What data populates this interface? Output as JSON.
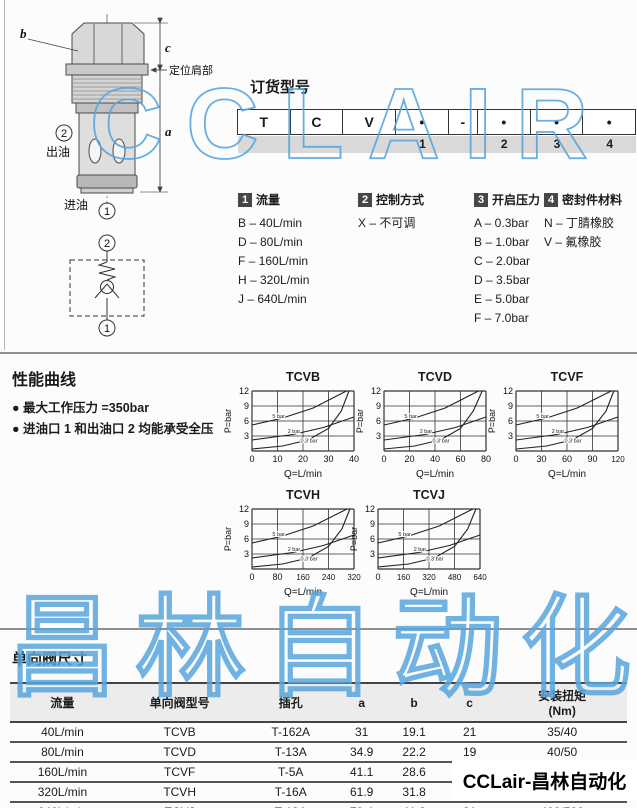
{
  "brand": {
    "label": "CCLair-昌林自动化"
  },
  "watermarks": {
    "top": "CCLAIR",
    "bottom": "昌林自动化",
    "color": "#58a6de"
  },
  "drawing": {
    "dim_b": "b",
    "dim_c": "c",
    "dim_a": "a",
    "shoulder_label": "定位肩部",
    "outlet_num": "2",
    "outlet_label": "出油",
    "inlet_label": "进油",
    "inlet_num": "1",
    "symbol_top_num": "2",
    "symbol_bottom_num": "1"
  },
  "ordering": {
    "title": "订货型号",
    "cells": [
      "T",
      "C",
      "V",
      "•",
      "-",
      "•",
      "•",
      "•"
    ],
    "cell_numbers": [
      "",
      "",
      "",
      "1",
      "",
      "2",
      "3",
      "4"
    ],
    "groups": [
      {
        "num": "1",
        "title": "流量",
        "options": [
          "B – 40L/min",
          "D – 80L/min",
          "F – 160L/min",
          "H – 320L/min",
          "J – 640L/min"
        ]
      },
      {
        "num": "2",
        "title": "控制方式",
        "options": [
          "X – 不可调"
        ]
      },
      {
        "num": "3",
        "title": "开启压力",
        "options": [
          "A – 0.3bar",
          "B – 1.0bar",
          "C – 2.0bar",
          "D – 3.5bar",
          "E – 5.0bar",
          "F – 7.0bar"
        ]
      },
      {
        "num": "4",
        "title": "密封件材料",
        "options": [
          "N – 丁腈橡胶",
          "V – 氟橡胶"
        ]
      }
    ]
  },
  "performance": {
    "title": "性能曲线",
    "bullets": [
      "最大工作压力 =350bar",
      "进油口 1 和出油口 2 均能承受全压"
    ]
  },
  "chart_data": [
    {
      "type": "line",
      "title": "TCVB",
      "xlabel": "Q=L/min",
      "ylabel": "P=bar",
      "xmax": 40,
      "ylim": [
        0,
        12
      ],
      "x_ticks": [
        0,
        10,
        20,
        30,
        40
      ],
      "y_ticks": [
        0,
        3,
        6,
        9,
        12
      ],
      "grid": true,
      "series": [
        {
          "name": "5 bar",
          "x": [
            0,
            12,
            24,
            37
          ],
          "y": [
            5.2,
            6.6,
            8.6,
            12
          ],
          "label_at": [
            8,
            6.6
          ]
        },
        {
          "name": "2 bar",
          "x": [
            0,
            16,
            28,
            40
          ],
          "y": [
            2.2,
            3.3,
            4.7,
            6.8
          ],
          "label_at": [
            14,
            3.6
          ]
        },
        {
          "name": "0.3 bar",
          "x": [
            0,
            12,
            22,
            30,
            35,
            38
          ],
          "y": [
            0.4,
            1,
            2.2,
            4.5,
            8,
            12
          ],
          "label_at": [
            19,
            1.7
          ]
        }
      ]
    },
    {
      "type": "line",
      "title": "TCVD",
      "xlabel": "Q=L/min",
      "ylabel": "P=bar",
      "xmax": 80,
      "ylim": [
        0,
        12
      ],
      "x_ticks": [
        0,
        20,
        40,
        60,
        80
      ],
      "y_ticks": [
        0,
        3,
        6,
        9,
        12
      ],
      "grid": true,
      "series": [
        {
          "name": "5 bar",
          "x": [
            0,
            24,
            48,
            74
          ],
          "y": [
            5.2,
            6.6,
            8.6,
            12
          ],
          "label_at": [
            16,
            6.6
          ]
        },
        {
          "name": "2 bar",
          "x": [
            0,
            32,
            56,
            80
          ],
          "y": [
            2.2,
            3.3,
            4.7,
            6.8
          ],
          "label_at": [
            28,
            3.6
          ]
        },
        {
          "name": "0.3 bar",
          "x": [
            0,
            24,
            44,
            60,
            70,
            77
          ],
          "y": [
            0.4,
            1,
            2.2,
            4.5,
            8,
            12
          ],
          "label_at": [
            38,
            1.7
          ]
        }
      ]
    },
    {
      "type": "line",
      "title": "TCVF",
      "xlabel": "Q=L/min",
      "ylabel": "P=bar",
      "xmax": 120,
      "ylim": [
        0,
        12
      ],
      "x_ticks": [
        0,
        30,
        60,
        90,
        120
      ],
      "y_ticks": [
        0,
        3,
        6,
        9,
        12
      ],
      "grid": true,
      "series": [
        {
          "name": "5 bar",
          "x": [
            0,
            36,
            72,
            112
          ],
          "y": [
            5.2,
            6.6,
            8.6,
            12
          ],
          "label_at": [
            24,
            6.6
          ]
        },
        {
          "name": "2 bar",
          "x": [
            0,
            48,
            84,
            120
          ],
          "y": [
            2.2,
            3.3,
            4.7,
            6.8
          ],
          "label_at": [
            42,
            3.6
          ]
        },
        {
          "name": "0.3 bar",
          "x": [
            0,
            36,
            66,
            90,
            106,
            115
          ],
          "y": [
            0.4,
            1,
            2.2,
            4.5,
            8,
            12
          ],
          "label_at": [
            57,
            1.7
          ]
        }
      ]
    },
    {
      "type": "line",
      "title": "TCVH",
      "xlabel": "Q=L/min",
      "ylabel": "P=bar",
      "xmax": 320,
      "ylim": [
        0,
        12
      ],
      "x_ticks": [
        0,
        80,
        160,
        240,
        320
      ],
      "y_ticks": [
        0,
        3,
        6,
        9,
        12
      ],
      "grid": true,
      "series": [
        {
          "name": "5 bar",
          "x": [
            0,
            96,
            192,
            298
          ],
          "y": [
            5.2,
            6.6,
            8.6,
            12
          ],
          "label_at": [
            64,
            6.6
          ]
        },
        {
          "name": "2 bar",
          "x": [
            0,
            128,
            224,
            320
          ],
          "y": [
            2.2,
            3.3,
            4.7,
            6.8
          ],
          "label_at": [
            112,
            3.6
          ]
        },
        {
          "name": "0.3 bar",
          "x": [
            0,
            96,
            176,
            240,
            282,
            307
          ],
          "y": [
            0.4,
            1,
            2.2,
            4.5,
            8,
            12
          ],
          "label_at": [
            152,
            1.7
          ]
        }
      ]
    },
    {
      "type": "line",
      "title": "TCVJ",
      "xlabel": "Q=L/min",
      "ylabel": "P=bar",
      "xmax": 640,
      "ylim": [
        0,
        12
      ],
      "x_ticks": [
        0,
        160,
        320,
        480,
        640
      ],
      "y_ticks": [
        0,
        3,
        6,
        9,
        12
      ],
      "grid": true,
      "series": [
        {
          "name": "5 bar",
          "x": [
            0,
            192,
            384,
            595
          ],
          "y": [
            5.2,
            6.6,
            8.6,
            12
          ],
          "label_at": [
            128,
            6.6
          ]
        },
        {
          "name": "2 bar",
          "x": [
            0,
            256,
            448,
            640
          ],
          "y": [
            2.2,
            3.3,
            4.7,
            6.8
          ],
          "label_at": [
            224,
            3.6
          ]
        },
        {
          "name": "0.3 bar",
          "x": [
            0,
            192,
            352,
            480,
            563,
            614
          ],
          "y": [
            0.4,
            1,
            2.2,
            4.5,
            8,
            12
          ],
          "label_at": [
            304,
            1.7
          ]
        }
      ]
    }
  ],
  "dimensions": {
    "title": "单向阀尺寸",
    "headers": [
      "流量",
      "单向阀型号",
      "插孔",
      "a",
      "b",
      "c",
      "安装扭矩\n(Nm)"
    ],
    "rows": [
      [
        "40L/min",
        "TCVB",
        "T-162A",
        "31",
        "19.1",
        "21",
        "35/40"
      ],
      [
        "80L/min",
        "TCVD",
        "T-13A",
        "34.9",
        "22.2",
        "19",
        "40/50"
      ],
      [
        "160L/min",
        "TCVF",
        "T-5A",
        "41.1",
        "28.6",
        "18",
        "60/70"
      ],
      [
        "320L/min",
        "TCVH",
        "T-16A",
        "61.9",
        "31.8",
        "25",
        "203/245"
      ],
      [
        "640L/min",
        "TCVJ",
        "T-18A",
        "79.4",
        "41.3",
        "31",
        "400/500"
      ]
    ]
  }
}
